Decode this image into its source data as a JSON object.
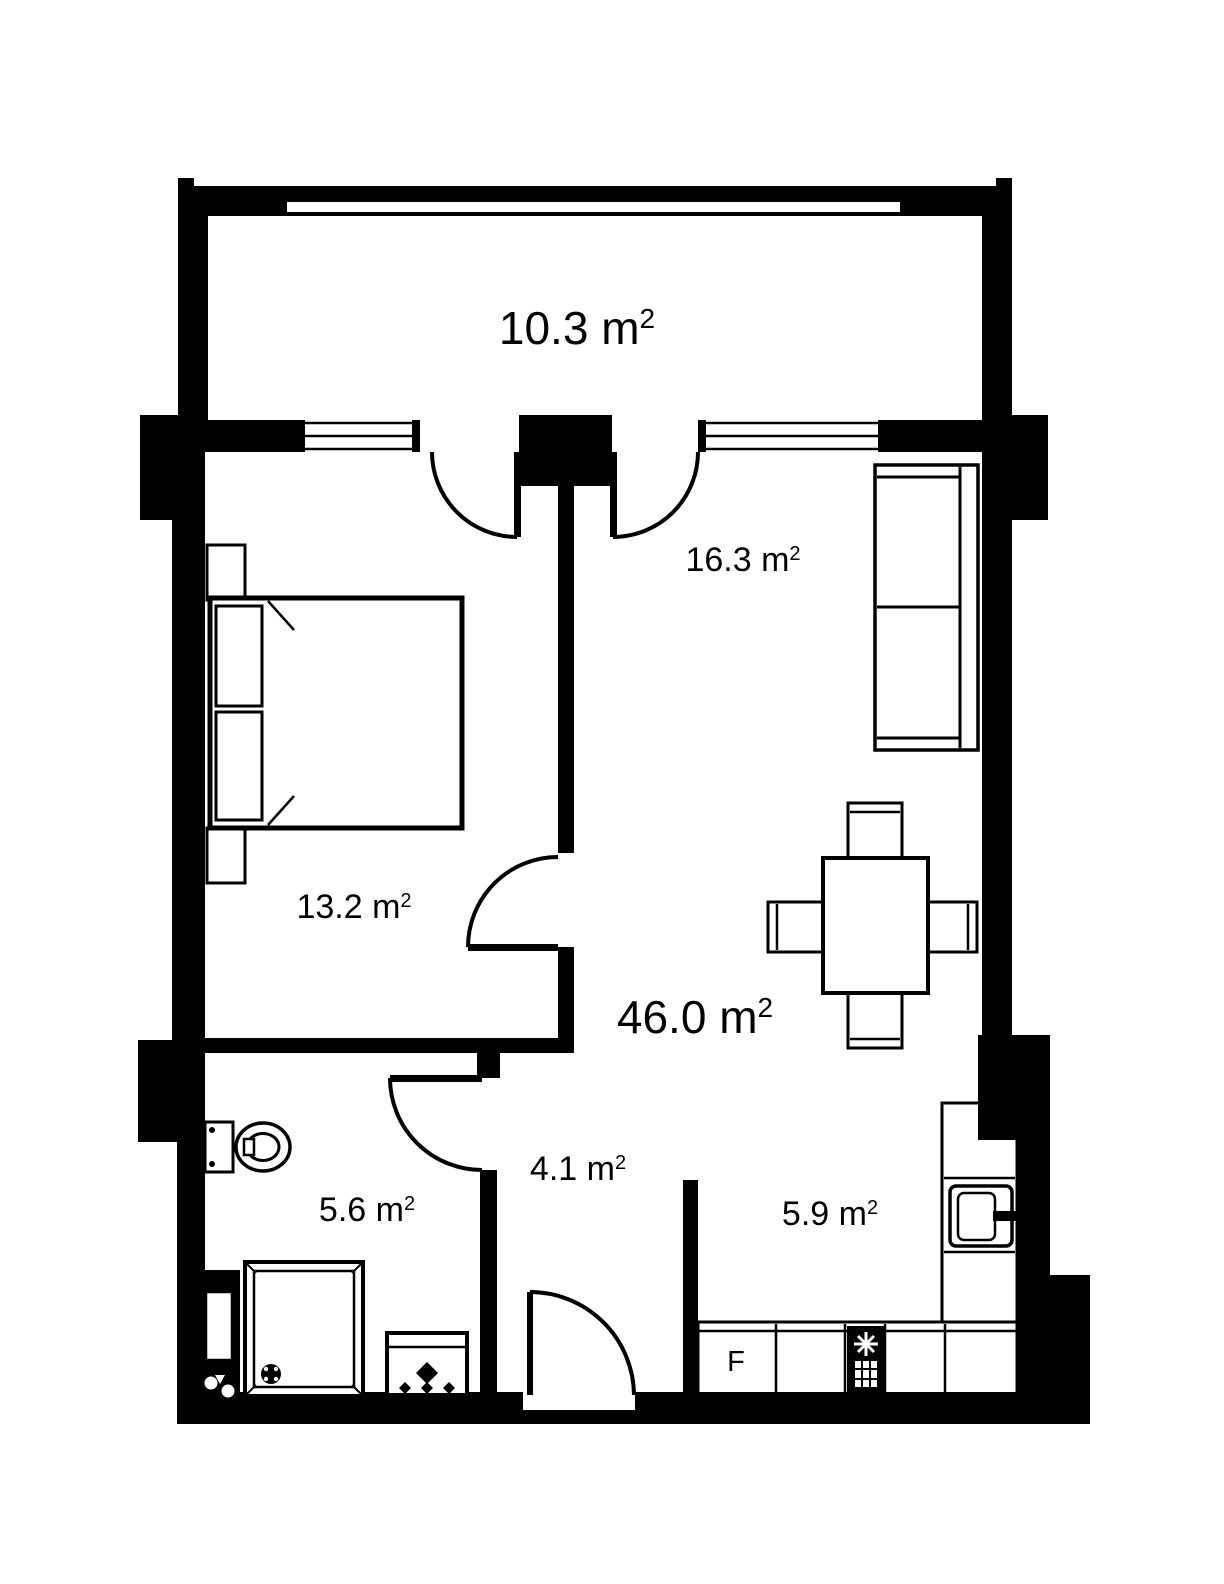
{
  "plan": {
    "type": "apartment-floor-plan",
    "colors": {
      "walls": "#000000",
      "background": "#ffffff",
      "text": "#000000"
    },
    "rooms": {
      "balcony": {
        "name": "balcony",
        "area_label": "10.3 m",
        "area_sup": "2"
      },
      "living_zone": {
        "name": "living zone",
        "area_label": "16.3 m",
        "area_sup": "2"
      },
      "bedroom": {
        "name": "bedroom",
        "area_label": "13.2 m",
        "area_sup": "2"
      },
      "living_total": {
        "name": "living room",
        "area_label": "46.0 m",
        "area_sup": "2"
      },
      "hallway": {
        "name": "hallway",
        "area_label": "4.1 m",
        "area_sup": "2"
      },
      "bathroom": {
        "name": "bathroom",
        "area_label": "5.6 m",
        "area_sup": "2"
      },
      "kitchen": {
        "name": "kitchen",
        "area_label": "5.9 m",
        "area_sup": "2"
      }
    },
    "appliances": {
      "fridge_label": "F"
    }
  }
}
